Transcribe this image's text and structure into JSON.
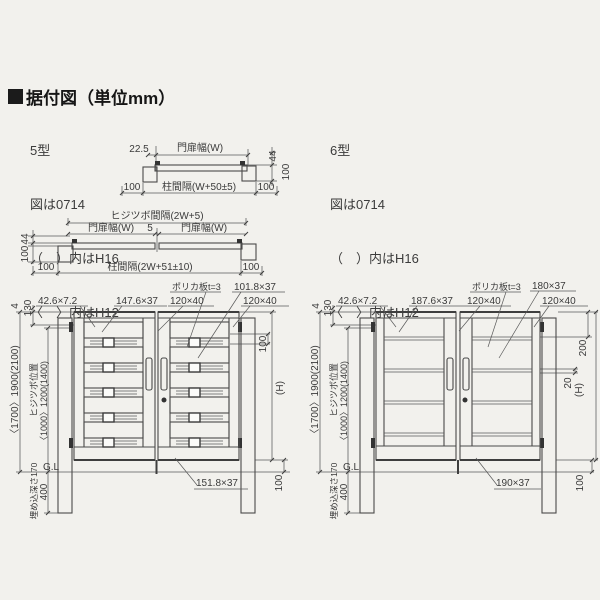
{
  "title": "据付図（単位mm）",
  "legend5": {
    "model": "5型",
    "fig": "図は0714",
    "note_h16": "（　）内はH16",
    "note_h12": "〈　〉内はH12"
  },
  "legend6": {
    "model": "6型",
    "fig": "図は0714",
    "note_h16": "（　）内はH16",
    "note_h12": "〈　〉内はH12"
  },
  "plan_single": {
    "offset": "22.5",
    "gate_width": "門扉幅(W)",
    "depth": "44",
    "post_depth": "100",
    "margin_left": "100",
    "post_span": "柱間隔(W+50±5)",
    "margin_right": "100"
  },
  "plan_double": {
    "hinge_span": "ヒジツボ間隔(2W+5)",
    "gate_width_left": "門扉幅(W)",
    "center_gap": "5",
    "gate_width_right": "門扉幅(W)",
    "depth": "44",
    "post_depth": "100",
    "margin_left": "100",
    "post_span": "柱間隔(2W+51±10)",
    "margin_right": "100"
  },
  "elev5": {
    "cap": "4",
    "top_offset": "130",
    "frame_cap": "42.6×7.2",
    "upper_board": "147.6×37",
    "stile_left": "120×40",
    "poly_board": "ポリカ板t=3",
    "louver_board": "101.8×37",
    "stile_right": "120×40",
    "pitch": "100",
    "gate_height": "(H)",
    "ground_clearance": "100",
    "total_height": "〈1700〉1900(2100)",
    "hinge_label": "ヒジツボ位置",
    "hinge_height": "〈1000〉1200(1400)",
    "embed_label": "埋め込深さ170",
    "embed_depth": "400",
    "ground_line": "G.L",
    "bottom_rail": "151.8×37"
  },
  "elev6": {
    "cap": "4",
    "top_offset": "130",
    "frame_cap": "42.6×7.2",
    "upper_board": "187.6×37",
    "stile_left": "120×40",
    "poly_board": "ポリカ板t=3",
    "louver_board": "180×37",
    "stile_right": "120×40",
    "top_board_height": "200",
    "board_gap": "20",
    "gate_height": "(H)",
    "ground_clearance": "100",
    "total_height": "〈1700〉1900(2100)",
    "hinge_label": "ヒジツボ位置",
    "hinge_height": "〈1000〉1200(1400)",
    "embed_label": "埋め込深さ170",
    "embed_depth": "400",
    "ground_line": "G.L",
    "bottom_rail": "190×37"
  }
}
